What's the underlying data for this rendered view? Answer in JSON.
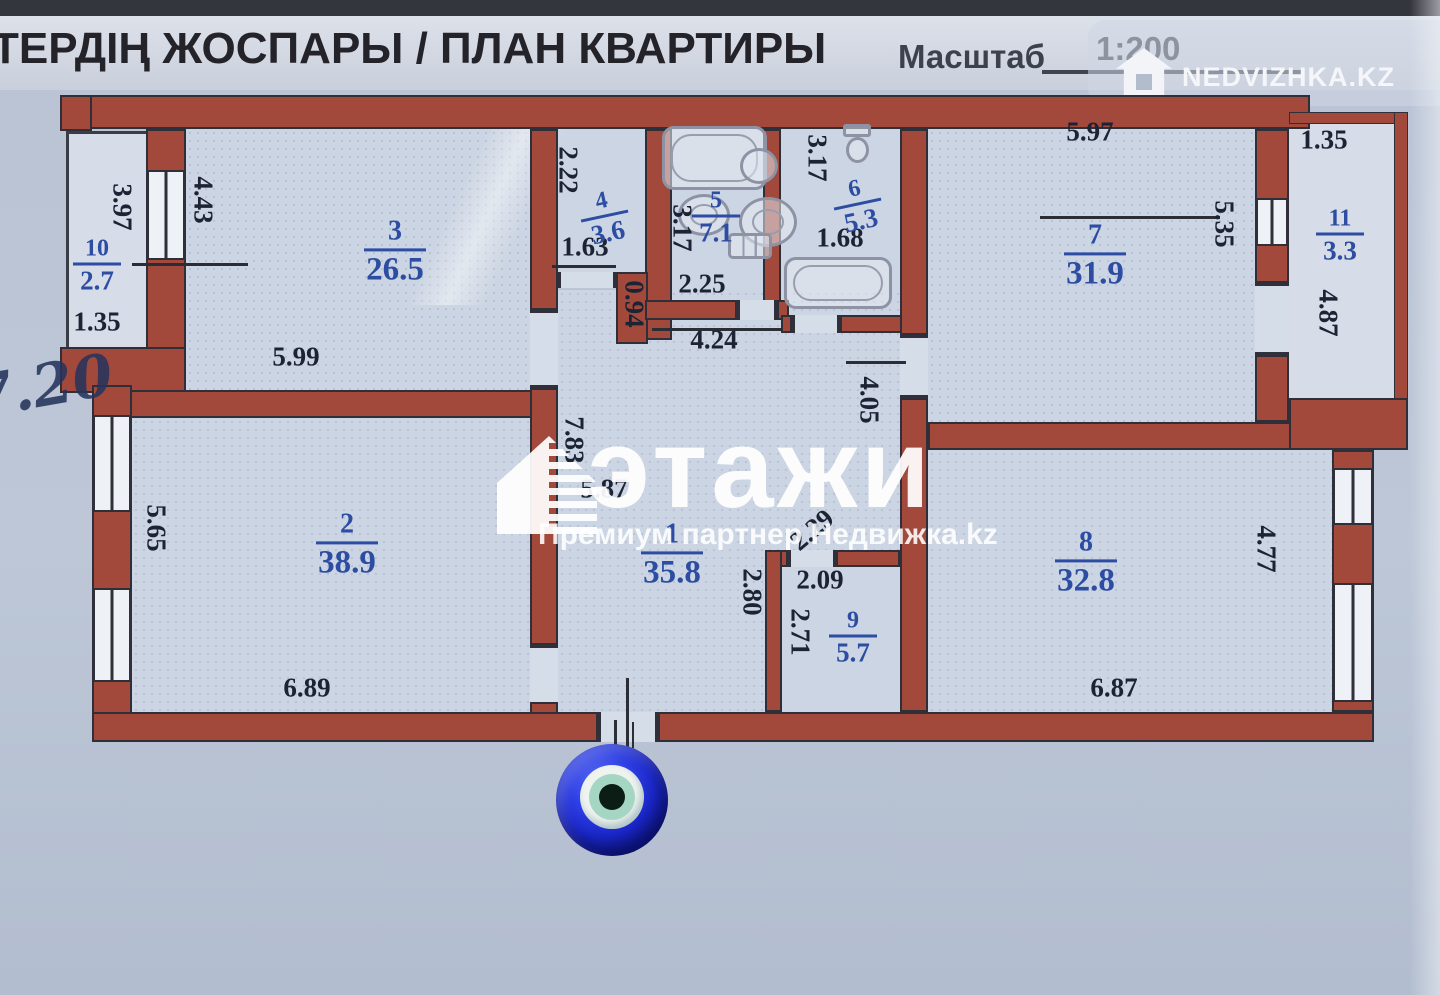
{
  "header": {
    "title": "ТЕРДІҢ ЖОСПАРЫ / ПЛАН КВАРТИРЫ",
    "scale_label": "Масштаб",
    "scale_value": "1:200",
    "logo_text": "NEDVIZHKA.KZ"
  },
  "watermark": {
    "brand": "этажи",
    "subtitle": "Премиум партнер Недвижка.kz"
  },
  "handwritten_note": "7.20",
  "plan": {
    "rooms": [
      {
        "num": "1",
        "area": "35.8"
      },
      {
        "num": "2",
        "area": "38.9"
      },
      {
        "num": "3",
        "area": "26.5"
      },
      {
        "num": "4",
        "area": "3.6"
      },
      {
        "num": "5",
        "area": "7.1"
      },
      {
        "num": "6",
        "area": "5.3"
      },
      {
        "num": "7",
        "area": "31.9"
      },
      {
        "num": "8",
        "area": "32.8"
      },
      {
        "num": "9",
        "area": "5.7"
      },
      {
        "num": "10",
        "area": "2.7"
      },
      {
        "num": "11",
        "area": "3.3"
      }
    ],
    "dims": {
      "r10_h": "3.97",
      "r3_side": "4.43",
      "r10_w": "1.35",
      "r3_w": "5.99",
      "r2_h": "5.65",
      "r2_w": "6.89",
      "r4_h": "2.22",
      "r4_door": "1.63",
      "r4_side": "0.94",
      "r5_h": "3.17",
      "r5_w": "2.25",
      "hall_top": "4.24",
      "r6_h": "3.17",
      "r6_w": "1.68",
      "r7_w": "5.97",
      "r7_h": "5.35",
      "r11_w": "1.35",
      "r11_h": "4.87",
      "corridor": "4.05",
      "niche": "2.29",
      "r9_w": "2.09",
      "hall_w": "2.80",
      "r9_h": "2.71",
      "r1_h": "7.83",
      "r1_w": "5.87",
      "r8_w": "6.87",
      "r8_h": "4.77"
    }
  },
  "colors": {
    "wall": "#a3493c",
    "room_label": "#2d4da2",
    "dimension": "#1c2334",
    "paper": "#c4cedc",
    "bead_blue": "#1b28cf",
    "bead_iris": "#a5d6c4"
  }
}
